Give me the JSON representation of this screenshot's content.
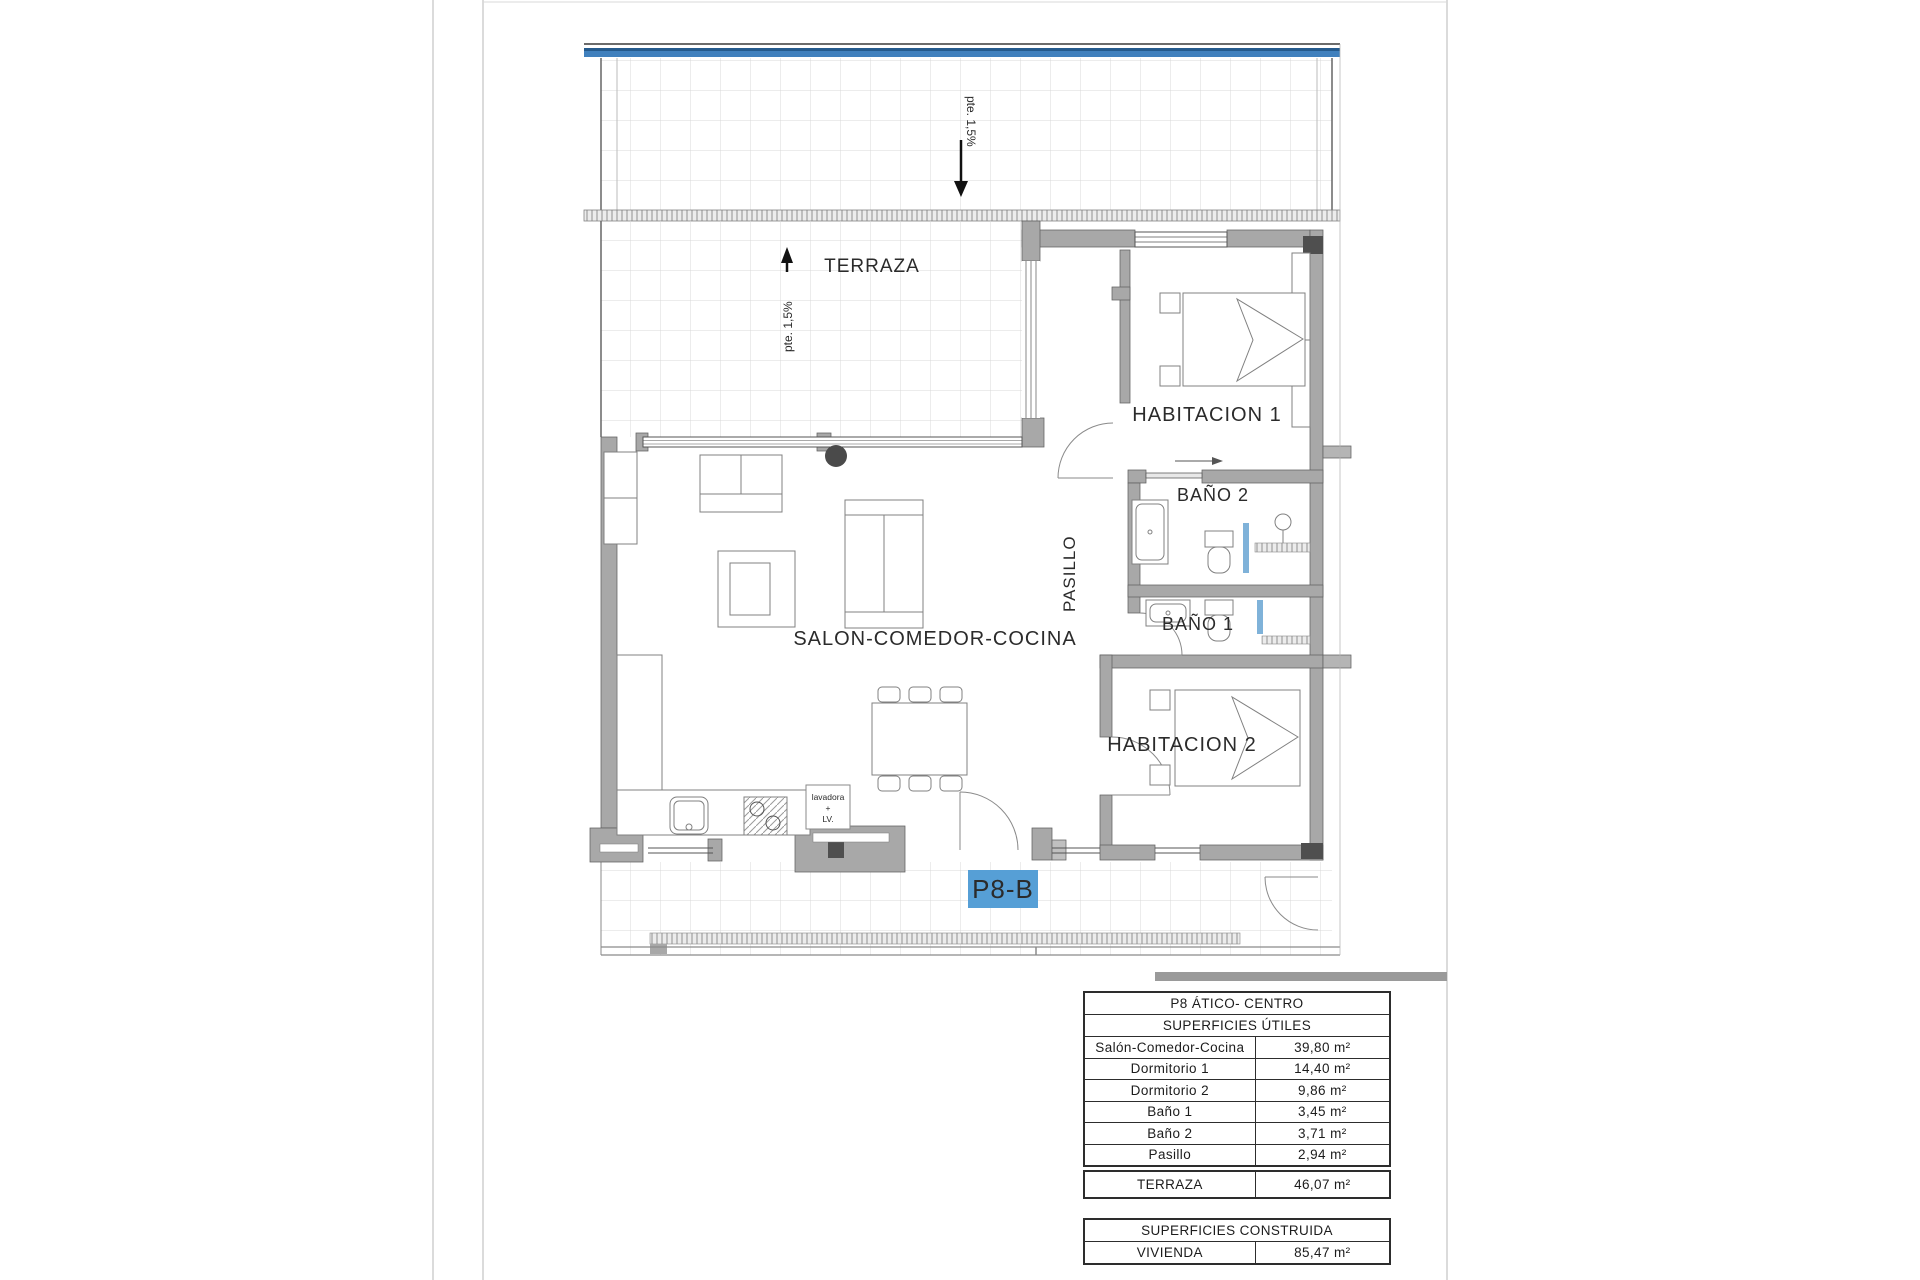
{
  "plan": {
    "rooms": {
      "terraza": "TERRAZA",
      "habitacion1": "HABITACION 1",
      "habitacion2": "HABITACION 2",
      "bano1": "BAÑO 1",
      "bano2": "BAÑO 2",
      "pasillo": "PASILLO",
      "salon": "SALON-COMEDOR-COCINA"
    },
    "annotations": {
      "slope_roof": "pte. 1,5%",
      "slope_terraza": "pte. 1,5%",
      "unit_badge": "P8-B",
      "appliance_line1": "lavadora",
      "appliance_line2": "+",
      "appliance_line3": "LV."
    },
    "colors": {
      "badge_blue": "#569fd6",
      "railing_blue": "#4080bd",
      "wall_gray": "#a8a8a8",
      "accent_dark": "#4f4f4f",
      "glass_blue": "#7fb2d9"
    }
  },
  "tables": {
    "main": {
      "title": "P8 ÁTICO- CENTRO",
      "subtitle": "SUPERFICIES ÚTILES",
      "rows": [
        {
          "label": "Salón-Comedor-Cocina",
          "value": "39,80 m²"
        },
        {
          "label": "Dormitorio 1",
          "value": "14,40 m²"
        },
        {
          "label": "Dormitorio 2",
          "value": "9,86 m²"
        },
        {
          "label": "Baño 1",
          "value": "3,45 m²"
        },
        {
          "label": "Baño 2",
          "value": "3,71 m²"
        },
        {
          "label": "Pasillo",
          "value": "2,94 m²"
        }
      ]
    },
    "terraza": {
      "label": "TERRAZA",
      "value": "46,07 m²"
    },
    "construida": {
      "title": "SUPERFICIES CONSTRUIDA",
      "rows": [
        {
          "label": "VIVIENDA",
          "value": "85,47 m²"
        }
      ]
    }
  }
}
